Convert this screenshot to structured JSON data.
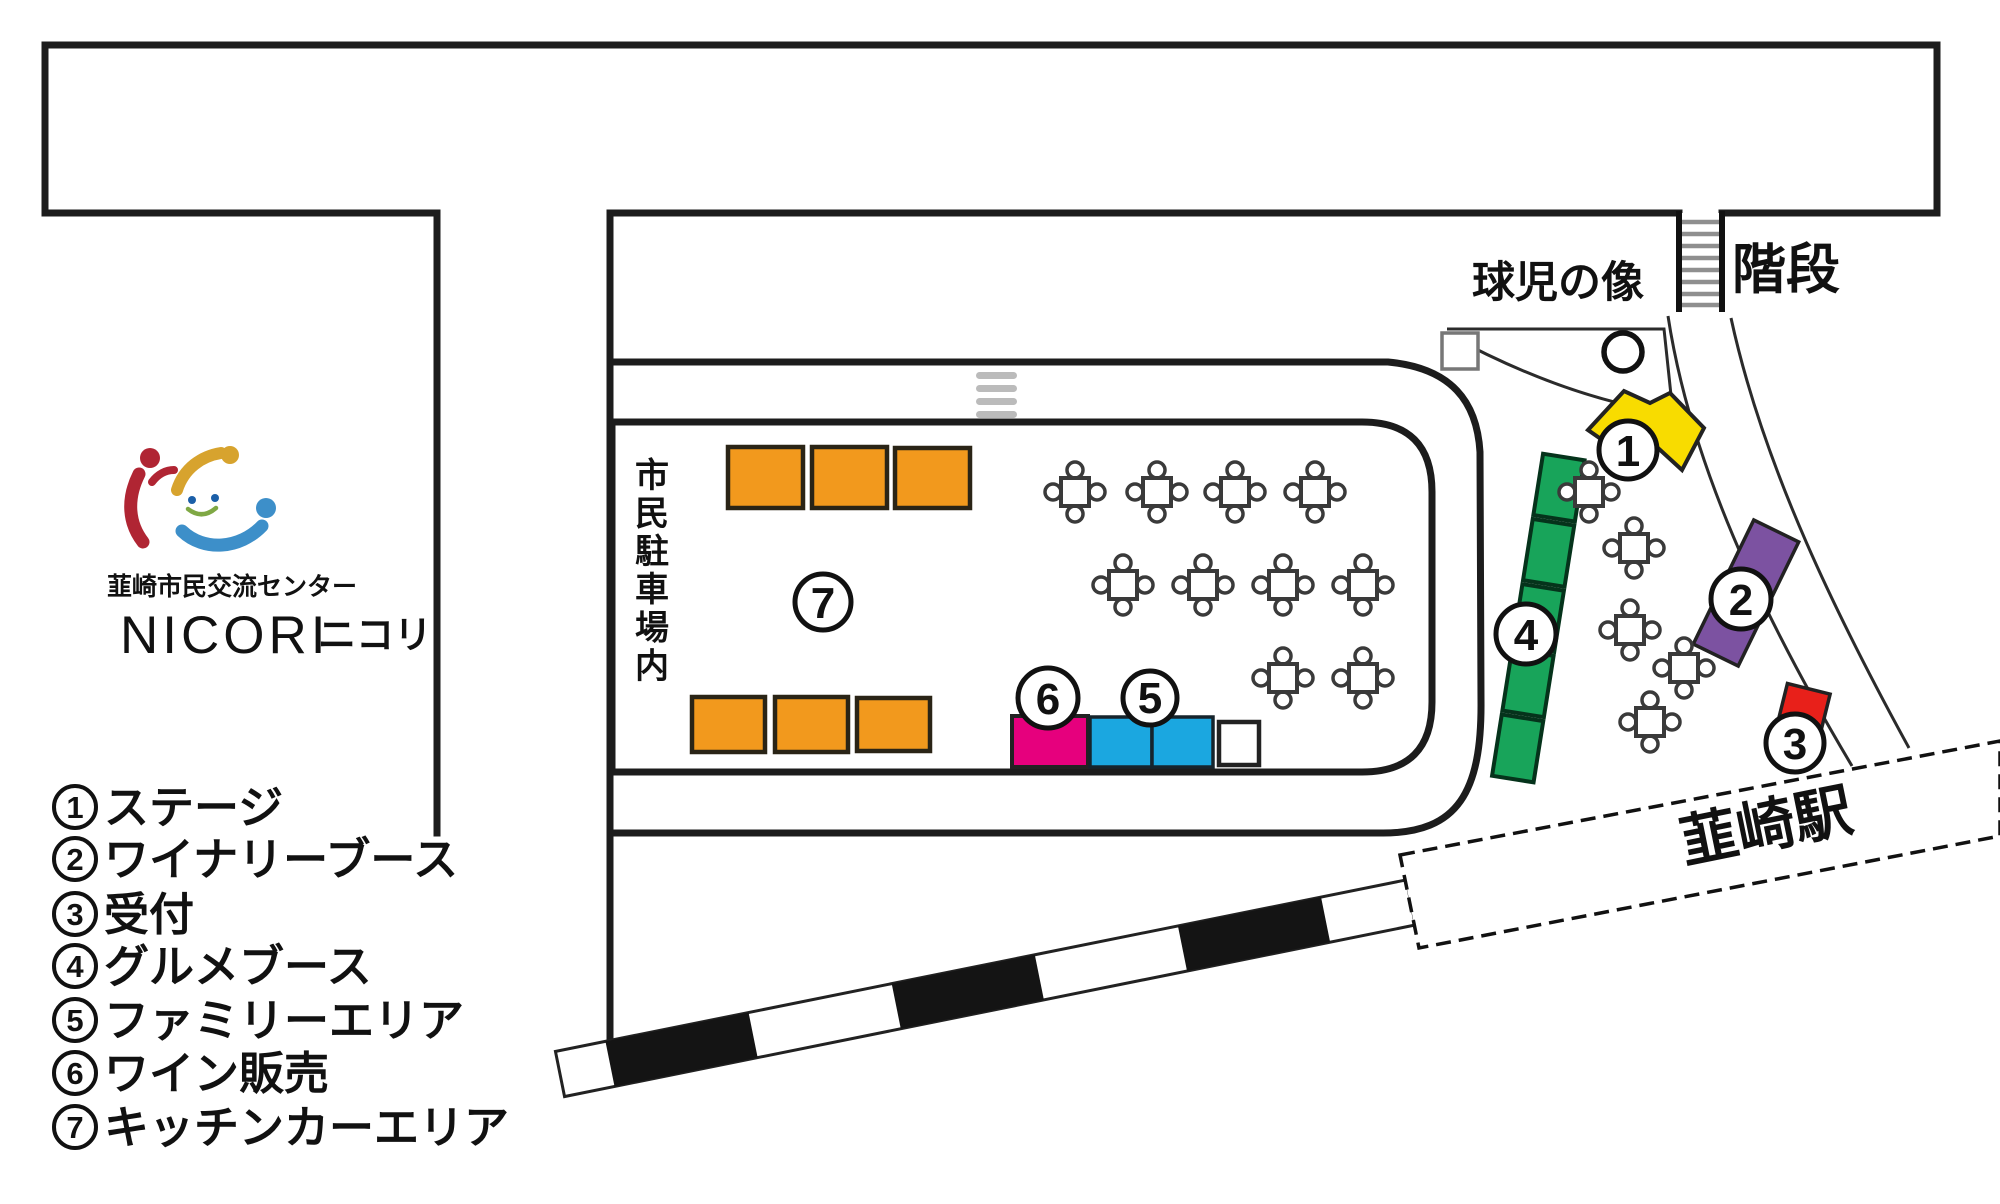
{
  "labels": {
    "stairs": "階段",
    "statue": "球児の像",
    "parking_vertical": "市民駐車場内",
    "station": "韮崎駅"
  },
  "org": {
    "name_ja": "韮崎市民交流センター",
    "name_en": "NICORI",
    "name_kana": "ニコリ"
  },
  "markers": {
    "m1": "1",
    "m2": "2",
    "m3": "3",
    "m4": "4",
    "m5": "5",
    "m6": "6",
    "m7": "7"
  },
  "legend": {
    "items": [
      {
        "number": "1",
        "label": "ステージ"
      },
      {
        "number": "2",
        "label": "ワイナリーブース"
      },
      {
        "number": "3",
        "label": "受付"
      },
      {
        "number": "4",
        "label": "グルメブース"
      },
      {
        "number": "5",
        "label": "ファミリーエリア"
      },
      {
        "number": "6",
        "label": "ワイン販売"
      },
      {
        "number": "7",
        "label": "キッチンカーエリア"
      }
    ]
  },
  "colors": {
    "kitchen_car_orange": "#F2991D",
    "wine_sale_pink": "#E6007D",
    "family_area_blue": "#1BA7E0",
    "gourmet_green": "#18A45A",
    "stage_yellow": "#F8DC00",
    "winery_purple": "#7C52A1",
    "reception_red": "#E8201A",
    "road_dash_gray": "#BBBBBB",
    "logo_red": "#B02533",
    "logo_gold": "#D7A32E",
    "logo_blue": "#3D8FC9",
    "logo_smile_green": "#7FA844",
    "logo_eye_blue": "#1B5FA8"
  }
}
